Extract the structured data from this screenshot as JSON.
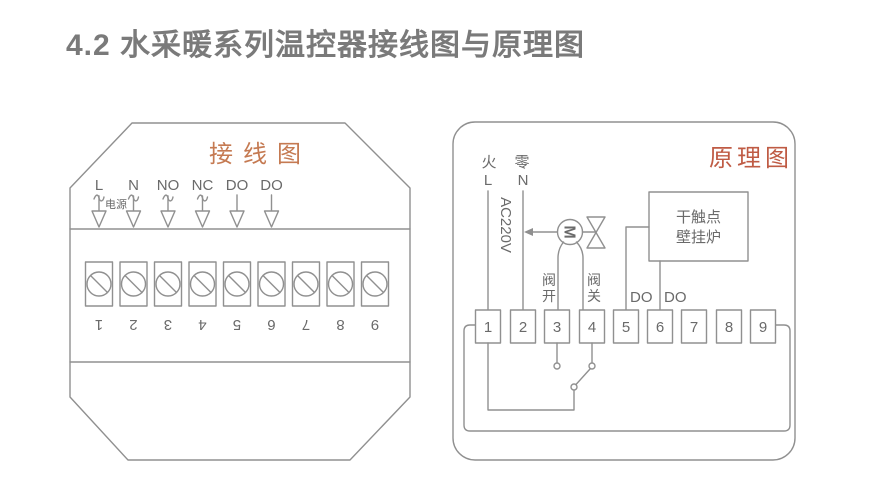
{
  "page": {
    "title": "4.2 水采暖系列温控器接线图与原理图"
  },
  "colors": {
    "line": "#909090",
    "text": "#6a6a6a",
    "page_title": "#7a7a7a",
    "accent_wiring": "#c57a52",
    "accent_schematic": "#bf5b44"
  },
  "wiring": {
    "title": "接线图",
    "power_label": "电源",
    "pin_labels": [
      "L",
      "N",
      "NO",
      "NC",
      "DO",
      "DO"
    ],
    "terminals": [
      "1",
      "2",
      "3",
      "4",
      "5",
      "6",
      "7",
      "8",
      "9"
    ]
  },
  "schematic": {
    "title": "原理图",
    "live_cn": "火",
    "live_l": "L",
    "neutral_cn": "零",
    "neutral_n": "N",
    "voltage": "AC220V",
    "motor_label": "M",
    "valve_open": "阀开",
    "valve_close": "阀关",
    "boiler_line1": "干触点",
    "boiler_line2": "壁挂炉",
    "do_left": "DO",
    "do_right": "DO",
    "terminals": [
      "1",
      "2",
      "3",
      "4",
      "5",
      "6",
      "7",
      "8",
      "9"
    ]
  }
}
